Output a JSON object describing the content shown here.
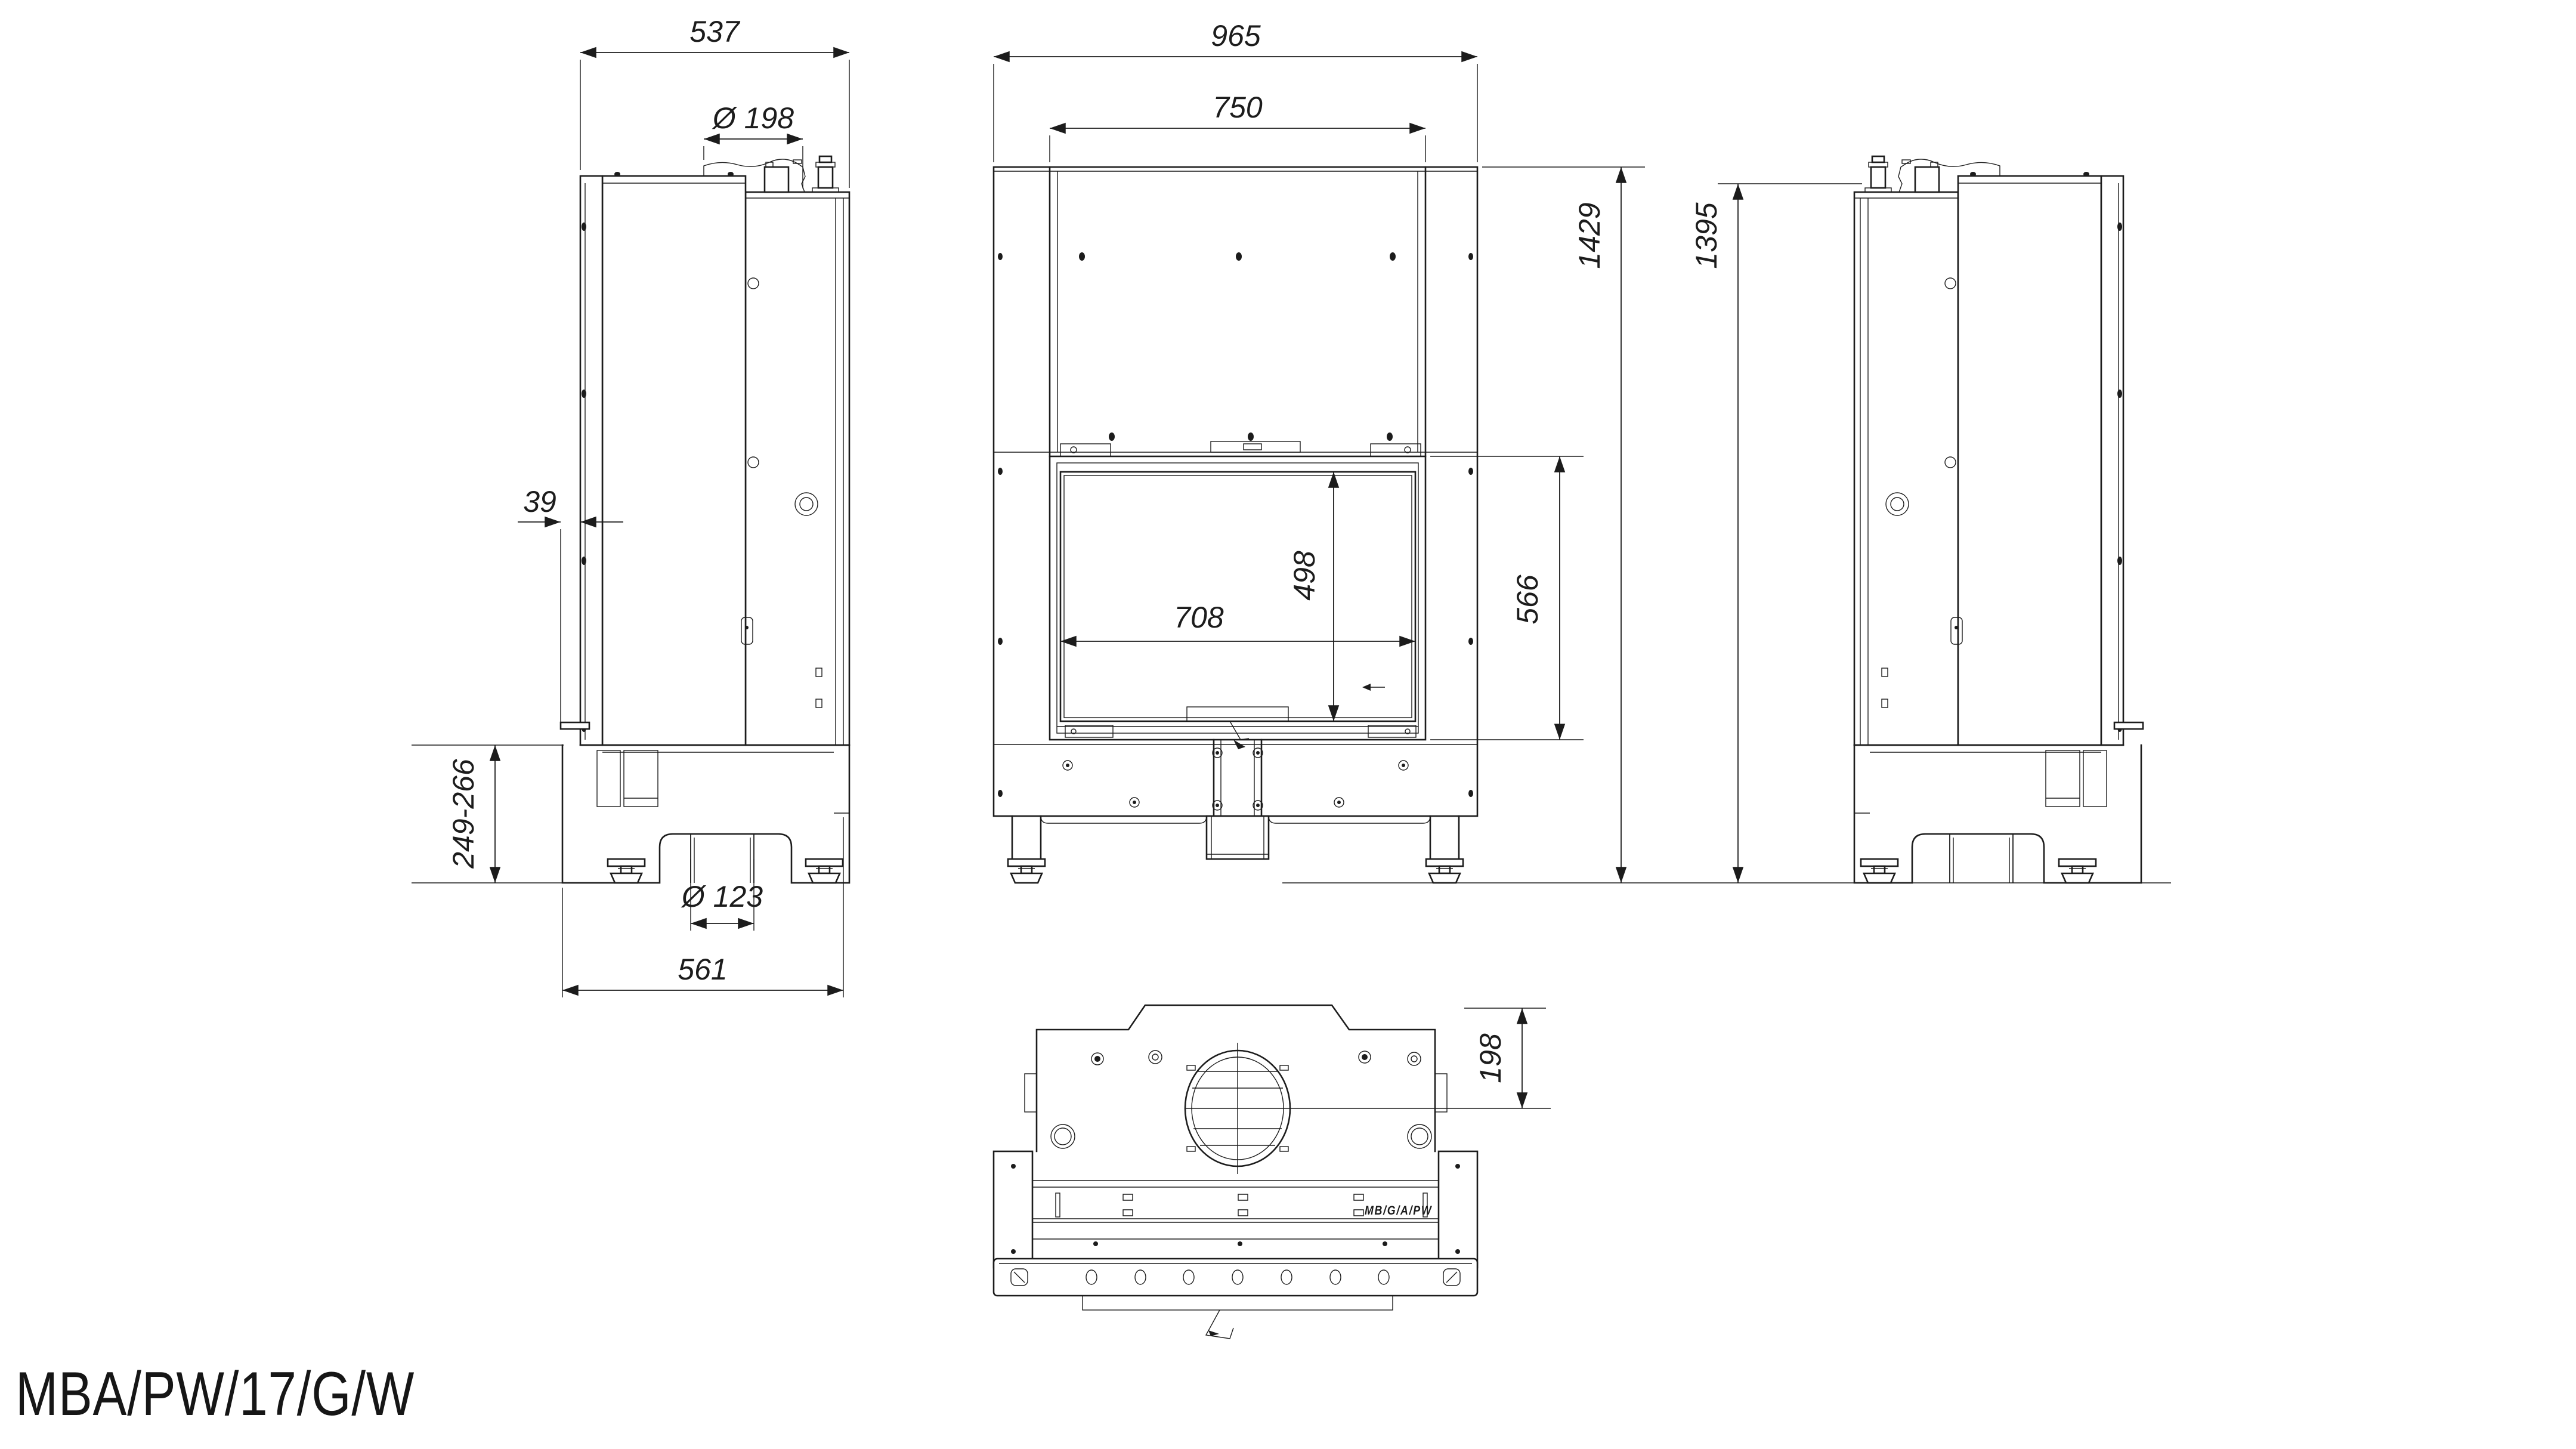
{
  "model_label": "MBA/PW/17/G/W",
  "drawing": {
    "line_color": "#1c1c1c",
    "background": "#ffffff",
    "type": "technical dimension drawing, fireplace water-jacket insert, 4 views"
  },
  "views": {
    "side_left": {
      "title": "left side view",
      "dims": {
        "depth_top": "537",
        "flue_diameter": "Ø 198",
        "front_lever_offset": "39",
        "plinth_height_range": "249-266",
        "air_inlet_diameter": "Ø 123",
        "depth_bottom": "561"
      }
    },
    "front": {
      "title": "front view",
      "dims": {
        "overall_width": "965",
        "upper_body_width": "750",
        "glass_height": "498",
        "glass_width": "708",
        "door_height": "566",
        "overall_height": "1429"
      }
    },
    "side_right": {
      "title": "right side view",
      "dims": {
        "body_height": "1395"
      }
    },
    "top": {
      "title": "top view",
      "dims": {
        "flue_center_offset": "198"
      },
      "part_marking": "MB/G/A/PW"
    }
  }
}
